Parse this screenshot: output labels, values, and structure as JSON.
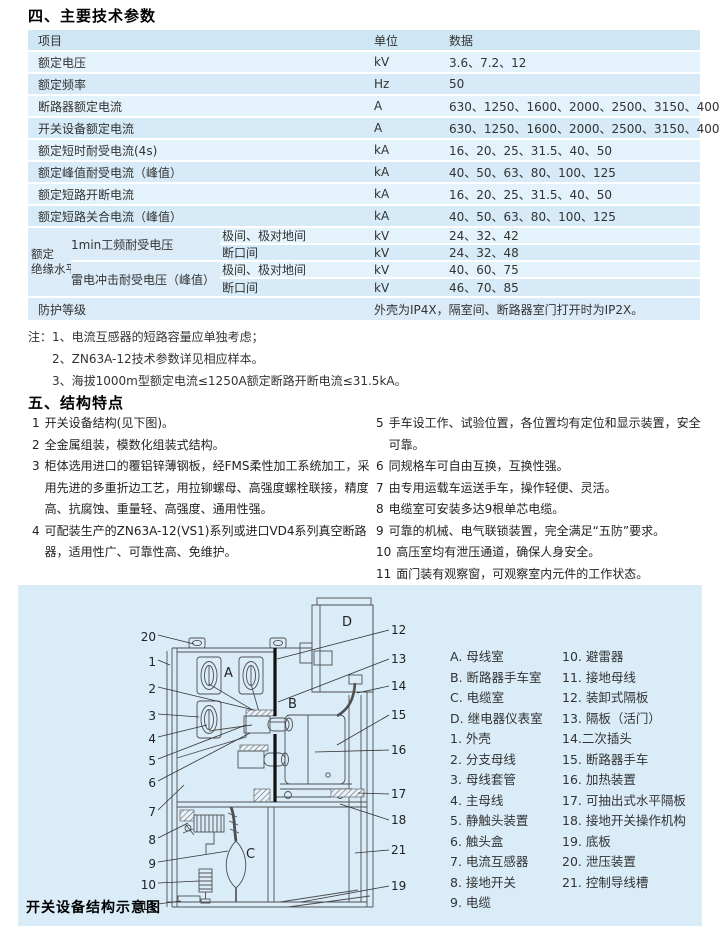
{
  "sections": {
    "params_title": "四、主要技术参数",
    "features_title": "五、结构特点",
    "diagram_caption": "开关设备结构示意图"
  },
  "params_table": {
    "header": {
      "item": "项目",
      "unit": "单位",
      "data": "数据"
    },
    "rows": [
      {
        "item": "额定电压",
        "unit": "kV",
        "data": "3.6、7.2、12"
      },
      {
        "item": "额定频率",
        "unit": "Hz",
        "data": "50"
      },
      {
        "item": "断路器额定电流",
        "unit": "A",
        "data": "630、1250、1600、2000、2500、3150、4000"
      },
      {
        "item": "开关设备额定电流",
        "unit": "A",
        "data": "630、1250、1600、2000、2500、3150、4000"
      },
      {
        "item": "额定短时耐受电流(4s)",
        "unit": "kA",
        "data": "16、20、25、31.5、40、50"
      },
      {
        "item": "额定峰值耐受电流（峰值）",
        "unit": "kA",
        "data": "40、50、63、80、100、125"
      },
      {
        "item": "额定短路开断电流",
        "unit": "kA",
        "data": "16、20、25、31.5、40、50"
      },
      {
        "item": "额定短路关合电流（峰值）",
        "unit": "kA",
        "data": "40、50、63、80、100、125"
      }
    ],
    "insulation": {
      "group_line1": "额定",
      "group_line2": "绝缘水平",
      "power_freq_label": "1min工频耐受电压",
      "impulse_label": "雷电冲击耐受电压（峰值）",
      "rows": [
        {
          "cond": "极间、极对地间",
          "unit": "kV",
          "data": "24、32、42"
        },
        {
          "cond": "断口间",
          "unit": "kV",
          "data": "24、32、48"
        },
        {
          "cond": "极间、极对地间",
          "unit": "kV",
          "data": "40、60、75"
        },
        {
          "cond": "断口间",
          "unit": "kV",
          "data": "46、70、85"
        }
      ]
    },
    "protection": {
      "item": "防护等级",
      "data": "外壳为IP4X，隔室间、断路器室门打开时为IP2X。"
    }
  },
  "notes": {
    "prefix": "注：",
    "items": [
      "1、电流互感器的短路容量应单独考虑；",
      "2、ZN63A-12技术参数详见相应样本。",
      "3、海拔1000m型额定电流≤1250A额定断路开断电流≤31.5kA。"
    ]
  },
  "features": {
    "left": [
      {
        "num": "1",
        "text": "开关设备结构(见下图)。"
      },
      {
        "num": "2",
        "text": "全金属组装，模数化组装式结构。"
      },
      {
        "num": "3",
        "text": "柜体选用进口的覆铝锌薄钢板，经FMS柔性加工系统加工，采用先进的多重折边工艺，用拉铆螺母、高强度螺栓联接，精度高、抗腐蚀、重量轻、高强度、通用性强。"
      },
      {
        "num": "4",
        "text": "可配装生产的ZN63A-12(VS1)系列或进口VD4系列真空断路器，适用性广、可靠性高、免维护。"
      }
    ],
    "right": [
      {
        "num": "5",
        "text": "手车设工作、试验位置，各位置均有定位和显示装置，安全可靠。"
      },
      {
        "num": "6",
        "text": "同规格车可自由互换，互换性强。"
      },
      {
        "num": "7",
        "text": "由专用运载车运送手车，操作轻便、灵活。"
      },
      {
        "num": "8",
        "text": "电缆室可安装多达9根单芯电缆。"
      },
      {
        "num": "9",
        "text": "可靠的机械、电气联锁装置，完全满足“五防”要求。"
      },
      {
        "num": "10",
        "text": "高压室均有泄压通道，确保人身安全。"
      },
      {
        "num": "11",
        "text": "面门装有观察窗，可观察室内元件的工作状态。"
      }
    ]
  },
  "diagram": {
    "legend_col1": [
      "A. 母线室",
      "B. 断路器手车室",
      "C. 电缆室",
      "D. 继电器仪表室",
      "1. 外壳",
      "2. 分支母线",
      "3. 母线套管",
      "4. 主母线",
      "5. 静触头装置",
      "6. 触头盒",
      "7. 电流互感器",
      "8. 接地开关",
      "9. 电缆"
    ],
    "legend_col2": [
      "10. 避雷器",
      "11. 接地母线",
      "12. 装卸式隔板",
      "13. 隔板（活门）",
      "14.二次插头",
      "15. 断路器手车",
      "16. 加热装置",
      "17. 可抽出式水平隔板",
      "18. 接地开关操作机构",
      "19. 底板",
      "20. 泄压装置",
      "21. 控制导线槽"
    ],
    "compartment_letters": {
      "a": "A",
      "b": "B",
      "c": "C",
      "d": "D"
    },
    "callouts": {
      "n1": "1",
      "n2": "2",
      "n3": "3",
      "n4": "4",
      "n5": "5",
      "n6": "6",
      "n7": "7",
      "n8": "8",
      "n9": "9",
      "n10": "10",
      "n11": "11",
      "n12": "12",
      "n13": "13",
      "n14": "14",
      "n15": "15",
      "n16": "16",
      "n17": "17",
      "n18": "18",
      "n19": "19",
      "n20": "20",
      "n21": "21"
    }
  },
  "colors": {
    "row_light": "#e4f2fb",
    "row_dark": "#d6eaf7",
    "header": "#cfe6f4",
    "merged": "#dbecf8",
    "panel": "#d9ecf8",
    "text": "#333333"
  }
}
